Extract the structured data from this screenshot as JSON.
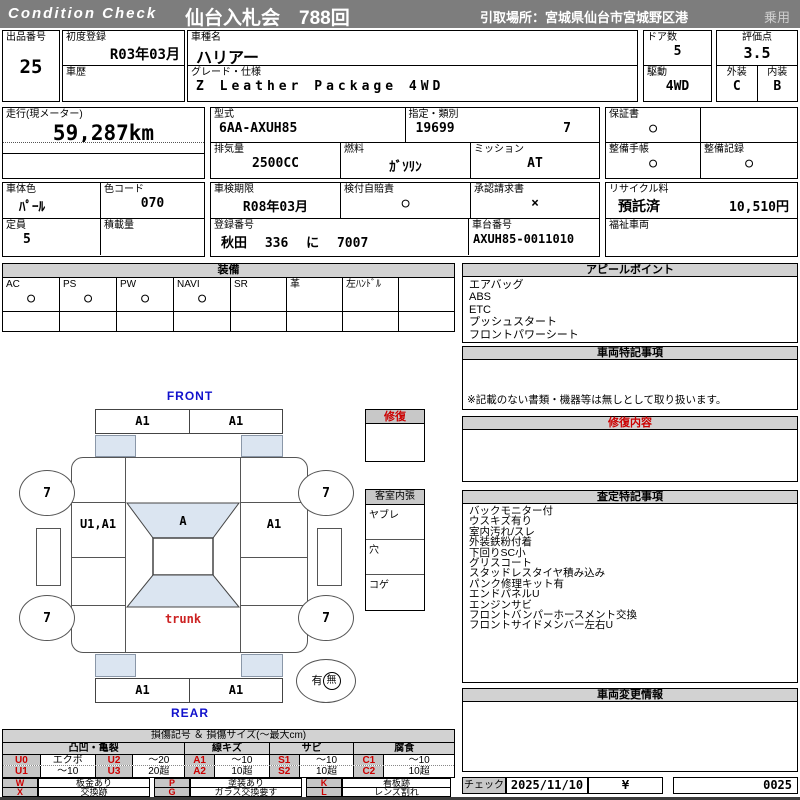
{
  "header": {
    "brand": "Condition Check",
    "auction_title": "仙台入札会　788回",
    "pickup": "引取場所：宮城県仙台市宮城野区港",
    "vehicle_class": "乗用"
  },
  "lot": {
    "label": "出品番号",
    "value": "25"
  },
  "vehicle": {
    "first_reg_label": "初度登録",
    "first_reg": "R03年03月",
    "history_label": "車歴",
    "history": "",
    "model_label": "車種名",
    "model": "ハリアー",
    "grade_label": "グレード・仕様",
    "grade": "Z Leather Package 4WD",
    "doors_label": "ドア数",
    "doors": "5",
    "score_label": "評価点",
    "score": "3.5",
    "drive_label": "駆動",
    "drive": "4WD",
    "exterior_label": "外装",
    "exterior_grade": "C",
    "interior_label": "内装",
    "interior_grade": "B"
  },
  "odometer": {
    "label": "走行(現メーター)",
    "value": "59,287km"
  },
  "spec": {
    "model_code_label": "型式",
    "model_code": "6AA-AXUH85",
    "class_label": "指定・類別",
    "class_no": "19699",
    "class_sub": "7",
    "displacement_label": "排気量",
    "displacement": "2500CC",
    "fuel_label": "燃料",
    "fuel": "ｶﾞｿﾘﾝ",
    "mission_label": "ミッション",
    "mission": "AT",
    "warranty_label": "保証書",
    "warranty": "○",
    "book_label": "整備手帳",
    "book": "○",
    "record_label": "整備記録",
    "record": "○"
  },
  "detail": {
    "body_color_label": "車体色",
    "body_color": "ﾊﾟｰﾙ",
    "color_code_label": "色コード",
    "color_code": "070",
    "capacity_label": "定員",
    "capacity": "5",
    "load_label": "積載量",
    "load": "",
    "inspection_label": "車検期限",
    "inspection": "R08年03月",
    "insurance_label": "検付自賠責",
    "insurance": "○",
    "approval_label": "承認請求書",
    "approval": "×",
    "regno_label": "登録番号",
    "regno": "秋田 336 に 7007",
    "chassis_label": "車台番号",
    "chassis": "AXUH85-0011010",
    "recycle_label": "リサイクル料",
    "recycle_status": "預託済",
    "recycle_fee": "10,510円",
    "welfare_label": "福祉車両",
    "welfare": ""
  },
  "equipment": {
    "title": "装備",
    "items": [
      {
        "label": "AC",
        "value": "○"
      },
      {
        "label": "PS",
        "value": "○"
      },
      {
        "label": "PW",
        "value": "○"
      },
      {
        "label": "NAVI",
        "value": "○"
      },
      {
        "label": "SR",
        "value": ""
      },
      {
        "label": "革",
        "value": ""
      },
      {
        "label": "左ﾊﾝﾄﾞﾙ",
        "value": ""
      },
      {
        "label": "",
        "value": ""
      }
    ]
  },
  "appeal": {
    "title": "アピールポイント",
    "items": [
      "エアバッグ",
      "ABS",
      "ETC",
      "プッシュスタート",
      "フロントパワーシート"
    ]
  },
  "special": {
    "title": "車両特記事項",
    "note": "※記載のない書類・機器等は無しとして取り扱います。"
  },
  "repair": {
    "title": "修復内容",
    "content": ""
  },
  "assessment": {
    "title": "査定特記事項",
    "items": [
      "バックモニター付",
      "ウスキズ有り",
      "室内汚れ/スレ",
      "外装鉄粉付着",
      "下回りSC小",
      "グリスコート",
      "スタッドレスタイヤ積み込み",
      "パンク修理キット有",
      "エンドパネルU",
      "エンジンサビ",
      "フロントバンパーホースメント交換",
      "フロントサイドメンバー左右U"
    ]
  },
  "change": {
    "title": "車両変更情報",
    "content": ""
  },
  "check": {
    "label": "チェック",
    "date": "2025/11/10",
    "currency": "¥",
    "number": "0025"
  },
  "diagram": {
    "front_label": "FRONT",
    "rear_label": "REAR",
    "front_bumper_left": "A1",
    "front_bumper_right": "A1",
    "rear_bumper_left": "A1",
    "rear_bumper_right": "A1",
    "left_panel": "U1,A1",
    "right_panel": "A1",
    "hood": "A",
    "trunk": "trunk",
    "tire_front_left": "7",
    "tire_front_right": "7",
    "tire_rear_left": "7",
    "tire_rear_right": "7",
    "spare_yes": "有",
    "spare_no": "無",
    "repair_flag": "修復",
    "interior_title": "客室内張",
    "interior_rows": [
      "ヤブレ",
      "穴",
      "コゲ"
    ]
  },
  "legend": {
    "title": "損傷記号 ＆ 損傷サイズ(〜最大cm)",
    "groups": [
      "凸凹・亀裂",
      "線キズ",
      "サビ",
      "腐食"
    ],
    "rows": [
      [
        "U0",
        "エクボ",
        "U2",
        "〜20",
        "A1",
        "〜10",
        "S1",
        "〜10",
        "C1",
        "〜10"
      ],
      [
        "U1",
        "〜10",
        "U3",
        "20超",
        "A2",
        "10超",
        "S2",
        "10超",
        "C2",
        "10超"
      ]
    ],
    "marks": [
      [
        "W",
        "板金あり",
        "P",
        "塗装あり",
        "K",
        "看板跡"
      ],
      [
        "X",
        "交換跡",
        "G",
        "ガラス交換要す",
        "L",
        "レンズ割れ"
      ]
    ]
  }
}
